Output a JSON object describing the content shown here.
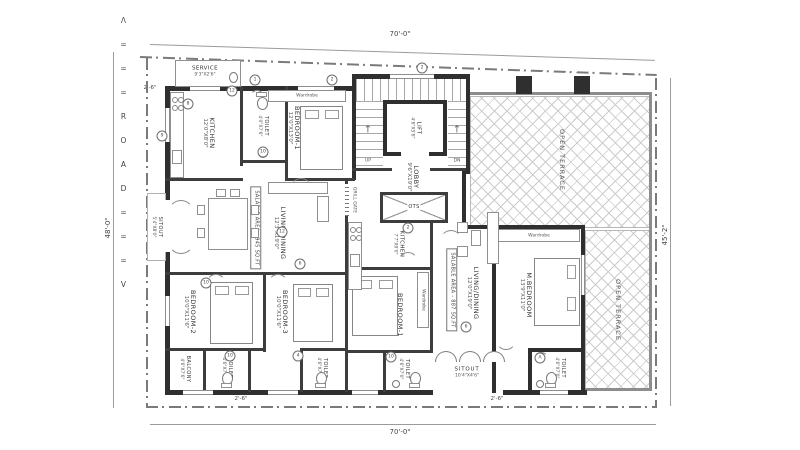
{
  "boundary": {
    "dims": {
      "top": "70'-0\"",
      "bottom": "70'-0\"",
      "left": "48'-0\"",
      "right": "45'-2\"",
      "offset_top_left": "2'-6\"",
      "offset_bottom_left": "2'-6\"",
      "offset_bottom_right": "2'-6\""
    }
  },
  "road": {
    "marking": "Λ===ROAD===V"
  },
  "core": {
    "lift": {
      "name": "LIFT",
      "dim": "4'6\"X5'6\""
    },
    "lobby": {
      "name": "LOBBY",
      "dim": "9'6\"X19'0\""
    },
    "ots": "OTS",
    "grill_gate": "GRILL GATE",
    "up": "UP",
    "dn": "DN",
    "up_arrow": "↑"
  },
  "unit_west": {
    "service": {
      "name": "SERVICE",
      "dim": "9'3\"X2'6\""
    },
    "kitchen": {
      "name": "KITCHEN",
      "dim": "12'0\"X8'0\""
    },
    "toilet_top": {
      "name": "TOILET",
      "dim": "4'0\"X7'6\""
    },
    "bedroom1": {
      "name": "BEDROOM-1",
      "dim": "12'0\"X13'0\""
    },
    "living": {
      "name": "LIVING/DINING",
      "dim": "12'3\"X19'0\""
    },
    "salable": "SALABLE AREA - 945 SQ.FT",
    "sitout": {
      "name": "SITOUT",
      "dim": "5'4\"X8'0\""
    },
    "bedroom2": {
      "name": "BEDROOM-2",
      "dim": "10'0\"X11'6\""
    },
    "bedroom3": {
      "name": "BEDROOM-3",
      "dim": "10'0\"X11'6\""
    },
    "balcony": {
      "name": "BALCONY",
      "dim": "4'6\"X7'6\""
    },
    "toilet_b1": {
      "name": "TOILET",
      "dim": "4'6\"X7'0\""
    },
    "toilet_b2": {
      "name": "TOILET",
      "dim": "4'6\"X7'0\""
    },
    "wardrobe": "Wardrobe"
  },
  "unit_east": {
    "kitchen": {
      "name": "KITCHEN",
      "dim": "7'7\"X9'0\""
    },
    "bedroom1": {
      "name": "BEDROOM-1",
      "dim": "11'0\"X13'0\""
    },
    "living": {
      "name": "LIVING/DINING",
      "dim": "12'0\"X19'0\""
    },
    "salable": "SALABLE AREA - 887 SQ.FT",
    "mbedroom": {
      "name": "M.BEDROOM",
      "dim": "13'9\"X11'0\""
    },
    "sitout": {
      "name": "SITOUT",
      "dim": "10'4\"X4'6\""
    },
    "toilet_1": {
      "name": "TOILET",
      "dim": "4'6\"X7'0\""
    },
    "toilet_2": {
      "name": "TOILET",
      "dim": "4'6\"X7'0\""
    },
    "wardrobe": "Wardrobe"
  },
  "terraces": {
    "ne": "OPEN TERRACE",
    "se": "OPEN TERRACE"
  },
  "tags": [
    "1",
    "2",
    "2",
    "12",
    "8",
    "10",
    "9",
    "12",
    "2",
    "6",
    "10",
    "10",
    "4",
    "10",
    "6",
    "A"
  ],
  "colors": {
    "wall": "#2f2f2f",
    "interior_wall": "#3d3d3d",
    "line": "#9b9b9b",
    "boundary": "#7a7a7a",
    "text": "#3a3a3a",
    "background": "#ffffff"
  }
}
